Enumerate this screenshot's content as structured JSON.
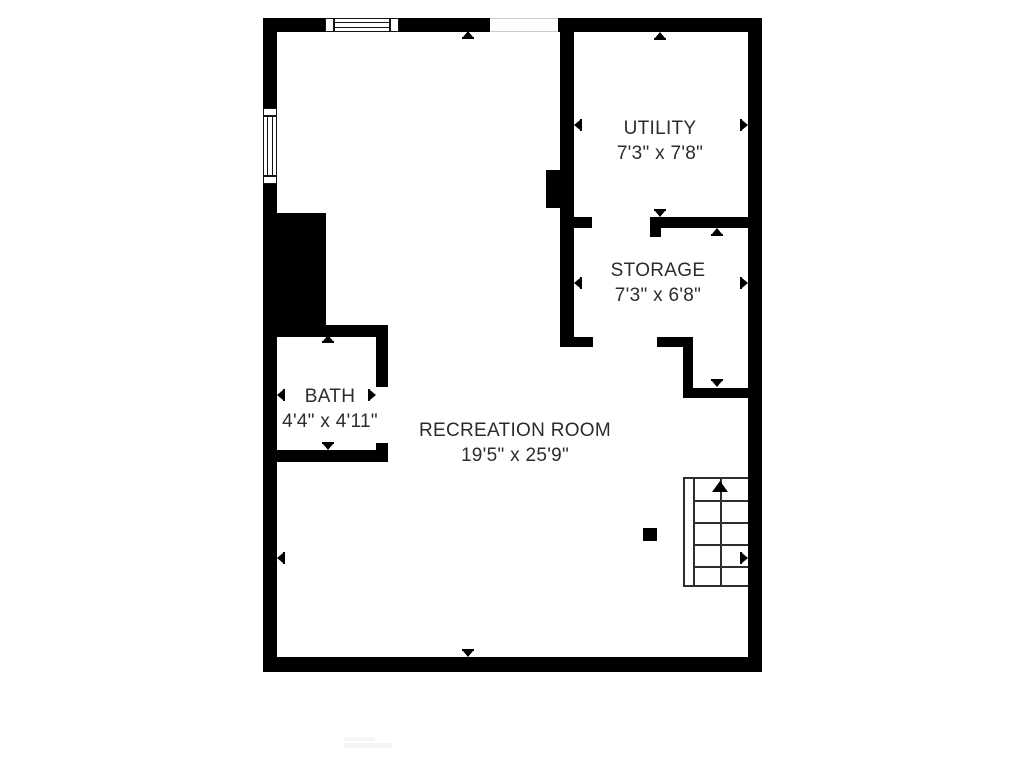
{
  "rooms": [
    {
      "name": "UTILITY",
      "dims": "7'3\" x 7'8\""
    },
    {
      "name": "STORAGE",
      "dims": "7'3\" x 6'8\""
    },
    {
      "name": "BATH",
      "dims": "4'4\" x 4'11\""
    },
    {
      "name": "RECREATION ROOM",
      "dims": "19'5\" x 25'9\""
    }
  ],
  "stairs": {
    "icon": "up-arrow"
  },
  "colors": {
    "wall": "#000000",
    "text": "#2c2c2c",
    "stair_line": "#2e2e2e",
    "opening_line": "#cccccc",
    "background": "#ffffff"
  }
}
